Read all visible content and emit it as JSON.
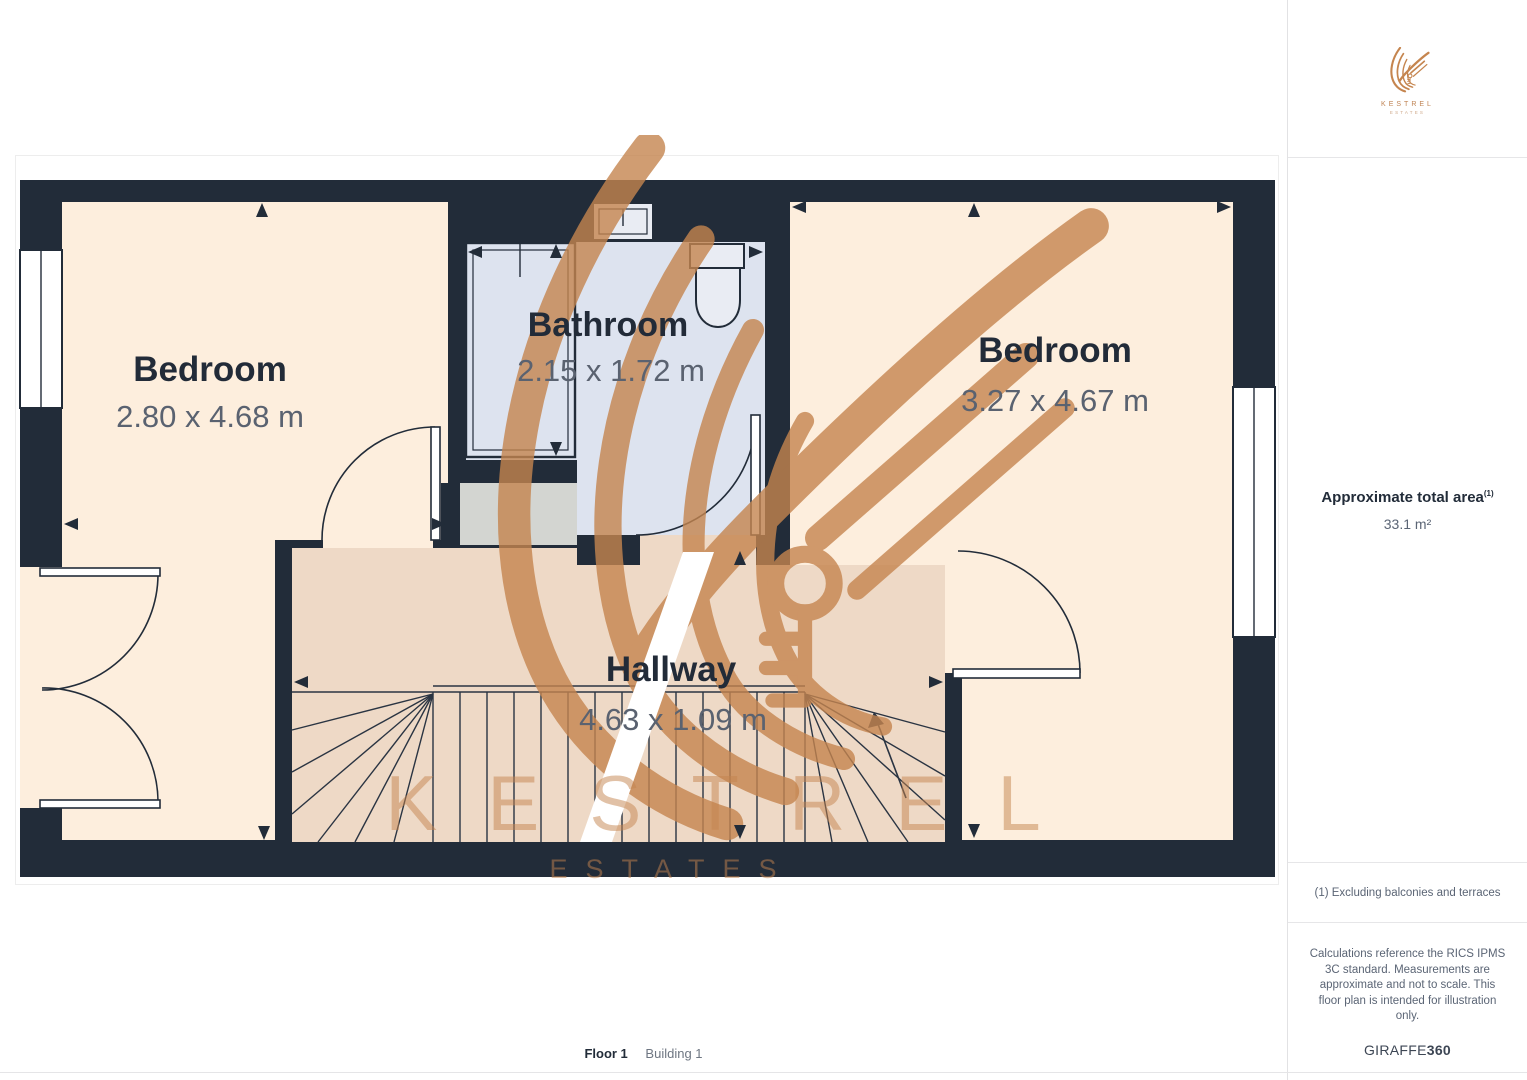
{
  "plan": {
    "rooms": [
      {
        "id": "bedroom-left",
        "name": "Bedroom",
        "dims": "2.80 x 4.68 m"
      },
      {
        "id": "bathroom",
        "name": "Bathroom",
        "dims": "2.15 x 1.72 m"
      },
      {
        "id": "bedroom-right",
        "name": "Bedroom",
        "dims": "3.27 x 4.67 m"
      },
      {
        "id": "hallway",
        "name": "Hallway",
        "dims": "4.63 x 1.09 m"
      }
    ],
    "watermark_brand": "KESTREL",
    "watermark_sub": "ESTATES"
  },
  "sidebar": {
    "logo_brand": "KESTREL",
    "logo_sub": "ESTATES",
    "area_label": "Approximate total area",
    "area_note_ref": "(1)",
    "area_value": "33.1 m²",
    "footnote": "(1) Excluding balconies and terraces",
    "disclaimer": "Calculations reference the RICS IPMS 3C standard. Measurements are approximate and not to scale. This floor plan is intended for illustration only.",
    "provider": "GIRAFFE",
    "provider_suffix": "360"
  },
  "footer": {
    "floor_label": "Floor 1",
    "building_label": "Building 1"
  },
  "colors": {
    "wall": "#222c39",
    "bedroom_floor": "#fdeedd",
    "bathroom_floor": "#dde3ef",
    "hallway_floor": "#eed9c6",
    "fixture_gray": "#d3d5d1",
    "watermark_copper": "#c5854f"
  }
}
